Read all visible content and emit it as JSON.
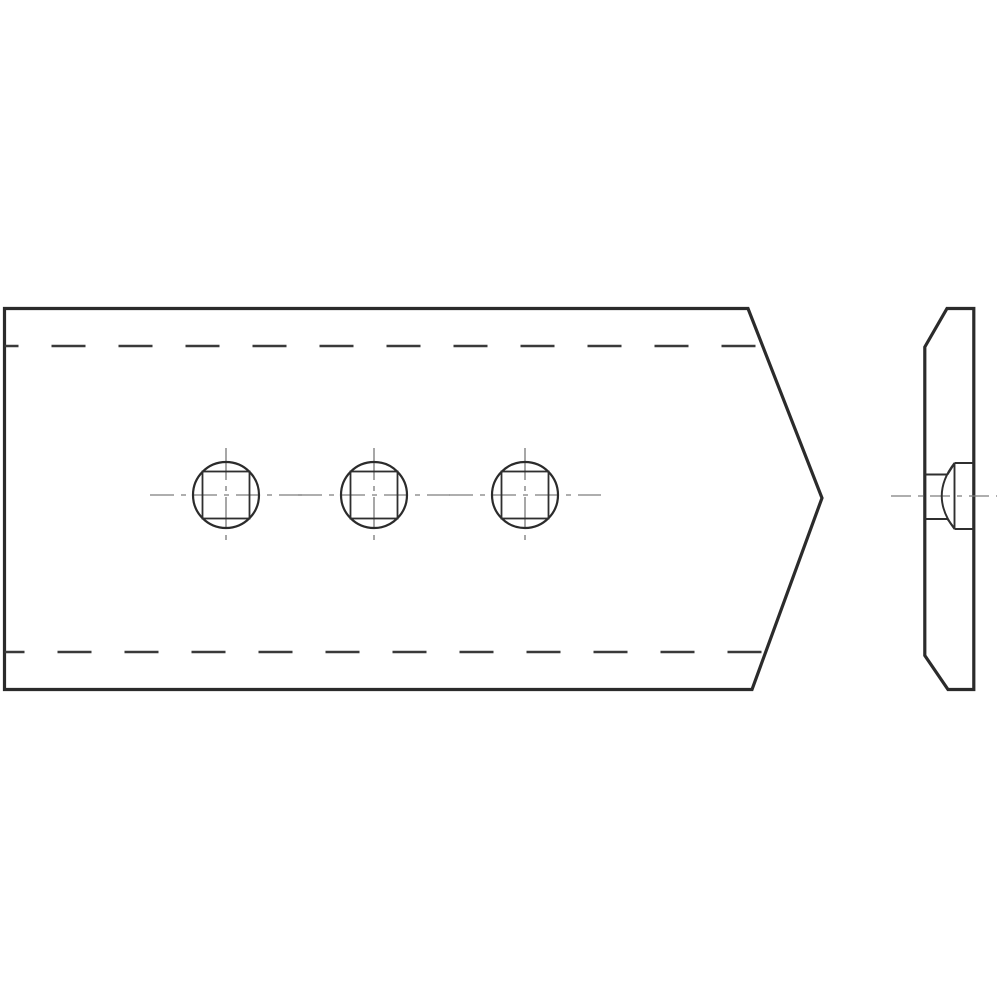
{
  "document": {
    "kind": "engineering-technical-drawing",
    "subject": "pointed share plate with three carriage-bolt holes, front view and side profile view",
    "background": "#ffffff"
  },
  "palette": {
    "outline": "#2b2b2b",
    "hidden_line": "#3a3a3a",
    "detail_line": "#2f2f2f",
    "centerline": "#7d7d7d",
    "fill": "#ffffff"
  },
  "line_weights": {
    "outline": 3.2,
    "hidden": 2.6,
    "circle": 2.2,
    "square": 1.8,
    "detail": 1.9,
    "centerline": 1.35
  },
  "front_view": {
    "outline_points": [
      [
        4.5,
        308.5
      ],
      [
        748,
        308.5
      ],
      [
        822,
        498
      ],
      [
        752,
        689.5
      ],
      [
        4.5,
        689.5
      ]
    ],
    "hidden_edges": [
      {
        "y": 346,
        "x1": 4.5,
        "x2": 762.5,
        "dash": "34 33",
        "offset": 20
      },
      {
        "y": 652,
        "x1": 4.5,
        "x2": 765.5,
        "dash": "34 33",
        "offset": 14
      }
    ],
    "holes": {
      "cy": 495,
      "cx_list": [
        226,
        374,
        525
      ],
      "circle_radius": 33,
      "square_size": 47,
      "h_centerline_halfspan": 76,
      "v_centerline_halfspan": 47,
      "h_dash": "24 7 5 7",
      "v_dash": "32 6 5 6"
    }
  },
  "side_view": {
    "outline_points": [
      [
        947,
        308.5
      ],
      [
        973.8,
        308.5
      ],
      [
        973.8,
        689.5
      ],
      [
        948,
        689.5
      ],
      [
        924.8,
        655.5
      ],
      [
        924.8,
        347
      ]
    ],
    "bolt_seat": {
      "rect": {
        "x1": 954.5,
        "y1": 463,
        "x2": 973.8,
        "y2": 529
      },
      "face_lines_y": [
        474.5,
        519
      ],
      "face_x1": 924.8,
      "face_x2": 947.5,
      "slants": [
        [
          [
            947.5,
            474.5
          ],
          [
            954.5,
            463.5
          ]
        ],
        [
          [
            947.5,
            519
          ],
          [
            954.5,
            528.5
          ]
        ]
      ],
      "dome_arc": {
        "x": 954.5,
        "y_top": 463,
        "y_bottom": 529,
        "ctrl_x": 929,
        "ctrl_y": 496
      }
    },
    "centerline": {
      "y": 496,
      "x1": 891,
      "x2": 997,
      "dash": "20 7 5 7"
    }
  }
}
